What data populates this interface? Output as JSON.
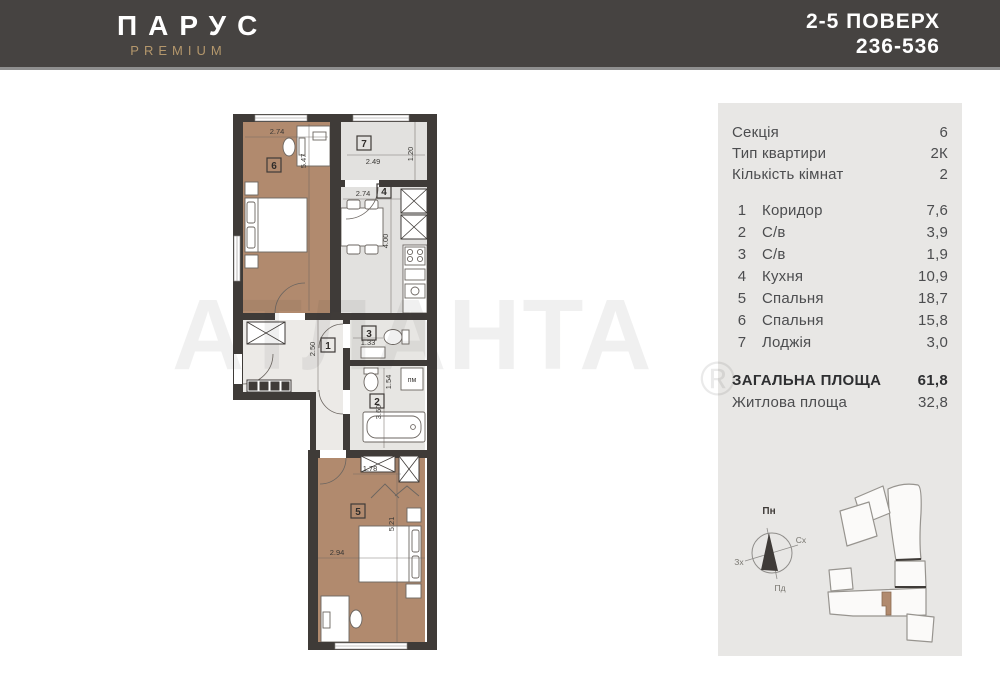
{
  "header": {
    "brand": "ПАРУС",
    "brand_sub": "PREMIUM",
    "floors": "2-5 ПОВЕРХ",
    "numbers": "236-536"
  },
  "panel": {
    "meta": [
      {
        "label": "Секція",
        "value": "6"
      },
      {
        "label": "Тип квартири",
        "value": "2К"
      },
      {
        "label": "Кількість кімнат",
        "value": "2"
      }
    ],
    "rooms": [
      {
        "num": "1",
        "name": "Коридор",
        "area": "7,6"
      },
      {
        "num": "2",
        "name": "С/в",
        "area": "3,9"
      },
      {
        "num": "3",
        "name": "С/в",
        "area": "1,9"
      },
      {
        "num": "4",
        "name": "Кухня",
        "area": "10,9"
      },
      {
        "num": "5",
        "name": "Спальня",
        "area": "18,7"
      },
      {
        "num": "6",
        "name": "Спальня",
        "area": "15,8"
      },
      {
        "num": "7",
        "name": "Лоджія",
        "area": "3,0"
      }
    ],
    "total": {
      "label": "ЗАГАЛЬНА ПЛОЩА",
      "value": "61,8"
    },
    "living": {
      "label": "Житлова площа",
      "value": "32,8"
    },
    "compass": {
      "n": "Пн",
      "e": "Сх",
      "s": "Пд",
      "w": "Зх"
    }
  },
  "plan": {
    "watermark": "АТЛАНТА",
    "reg_mark": "®",
    "washer": "пм",
    "rooms": {
      "r1": "1",
      "r2": "2",
      "r3": "3",
      "r4": "4",
      "r5": "5",
      "r6": "6",
      "r7": "7"
    },
    "dims": {
      "r6_w": "2.74",
      "r6_h": "5.47",
      "r7_w": "2.49",
      "r7_d": "1.20",
      "r4_w": "2.74",
      "r4_h": "4.00",
      "r1_h": "2.50",
      "r3_w": "1.33",
      "r2_w": "1.54",
      "r2_h": "3.60",
      "r5_niche": "1.78",
      "r5_h": "5.21",
      "r5_w": "2.94"
    }
  },
  "colors": {
    "header_bg": "#464341",
    "accent_gold": "#b4976c",
    "panel_bg": "#e8e7e5",
    "wall": "#3f3b38",
    "room_tan": "#b18a6e",
    "room_gray": "#e2e1df"
  }
}
